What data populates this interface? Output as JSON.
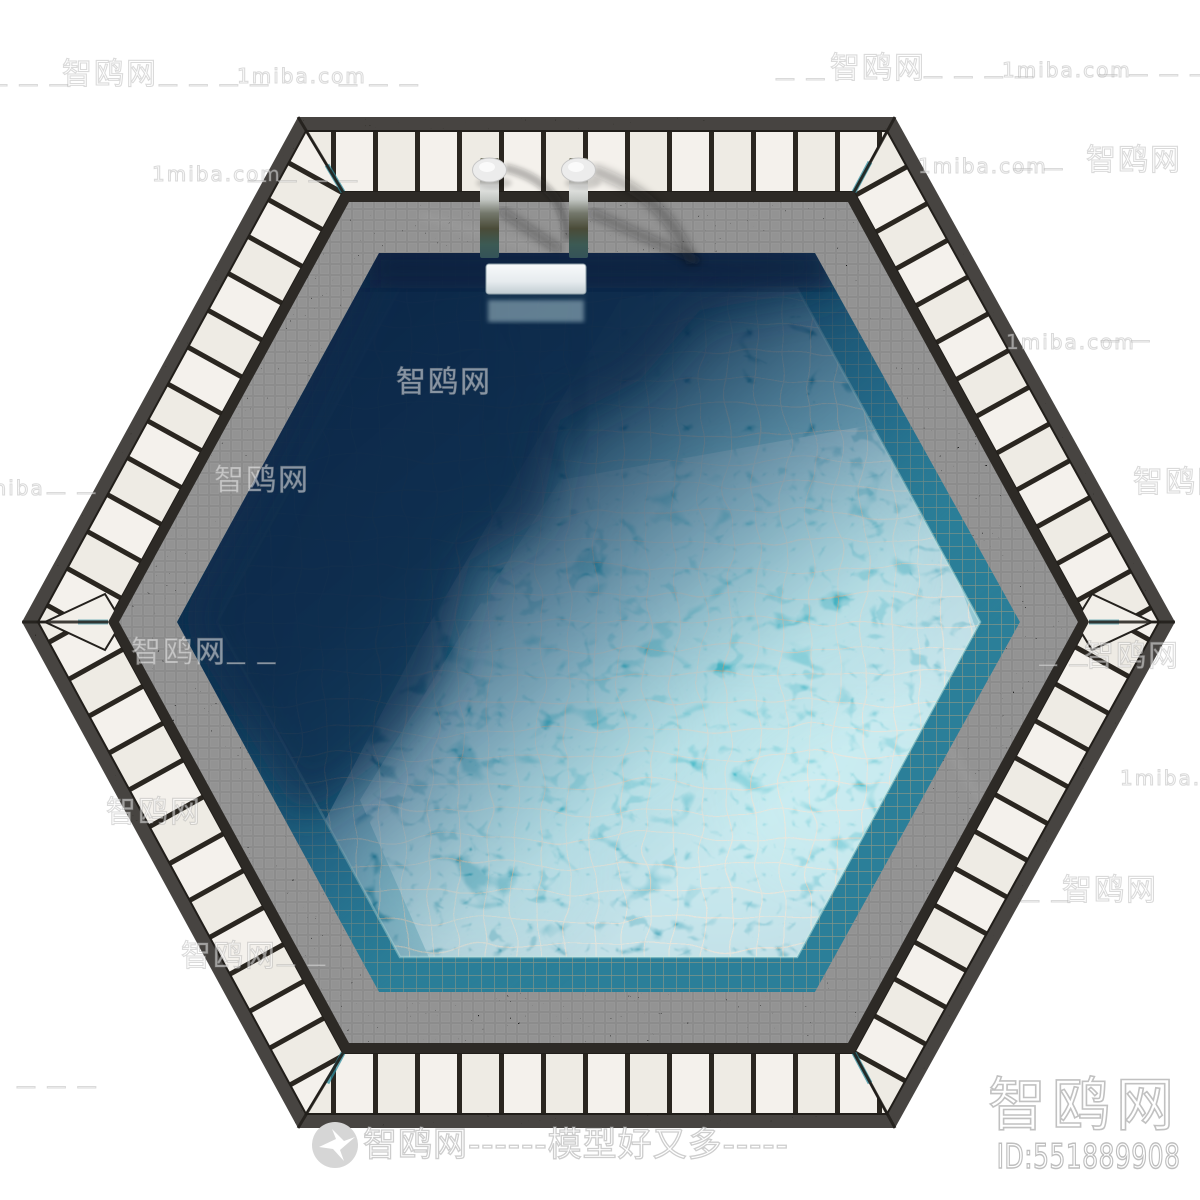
{
  "canvas": {
    "width": 1200,
    "height": 1200,
    "background": "#ffffff"
  },
  "scene": {
    "name": "hexagonal-swimming-pool-top-view-render",
    "colors": {
      "deck_plank": "#f4f1ec",
      "deck_gap": "#2a2620",
      "frame": "#2d2a26",
      "mosaic_tile": "#121212",
      "pool_wall": "#2b7f99",
      "water_bright": "#4ec6d2",
      "water_mid": "#3aa8bd",
      "water_deep": "#1a4a68",
      "water_shadow": "#0c2140",
      "grout": "#cda87e",
      "ladder_metal": "#c2c6c2",
      "ladder_step": "#f8fafb"
    }
  },
  "watermarks": {
    "tiled": [
      {
        "text": "— — —",
        "x": -12,
        "y": 74,
        "size": 20
      },
      {
        "text": "智鸥网",
        "x": 62,
        "y": 60,
        "size": 30
      },
      {
        "text": "— — — —",
        "x": 158,
        "y": 74,
        "size": 20
      },
      {
        "text": "1miba.com",
        "x": 237,
        "y": 66,
        "size": 20
      },
      {
        "text": "— — —",
        "x": 338,
        "y": 74,
        "size": 20
      },
      {
        "text": "— —",
        "x": 775,
        "y": 68,
        "size": 20
      },
      {
        "text": "智鸥网",
        "x": 830,
        "y": 54,
        "size": 30
      },
      {
        "text": "— — — —",
        "x": 923,
        "y": 66,
        "size": 20
      },
      {
        "text": "1miba.com",
        "x": 1002,
        "y": 60,
        "size": 20
      },
      {
        "text": "— — — —",
        "x": 1098,
        "y": 64,
        "size": 20
      },
      {
        "text": "1miba.com",
        "x": 152,
        "y": 164,
        "size": 20
      },
      {
        "text": "— — — —",
        "x": 247,
        "y": 170,
        "size": 20
      },
      {
        "text": "1miba.com",
        "x": 918,
        "y": 156,
        "size": 20
      },
      {
        "text": "— —",
        "x": 1013,
        "y": 158,
        "size": 20
      },
      {
        "text": "智鸥网",
        "x": 1086,
        "y": 146,
        "size": 30
      },
      {
        "text": "智鸥网",
        "x": 396,
        "y": 368,
        "size": 30
      },
      {
        "text": "1miba.com",
        "x": 1006,
        "y": 332,
        "size": 20
      },
      {
        "text": "— —",
        "x": 1100,
        "y": 330,
        "size": 20
      },
      {
        "text": "1miba",
        "x": -28,
        "y": 478,
        "size": 20
      },
      {
        "text": "— —",
        "x": 46,
        "y": 482,
        "size": 20
      },
      {
        "text": "智鸥网",
        "x": 214,
        "y": 466,
        "size": 30
      },
      {
        "text": "智鸥网",
        "x": 1133,
        "y": 468,
        "size": 30
      },
      {
        "text": "智鸥网",
        "x": 131,
        "y": 638,
        "size": 30
      },
      {
        "text": "— —",
        "x": 226,
        "y": 652,
        "size": 20
      },
      {
        "text": "— —",
        "x": 1038,
        "y": 654,
        "size": 20
      },
      {
        "text": "智鸥网",
        "x": 1084,
        "y": 642,
        "size": 30
      },
      {
        "text": "1miba.com",
        "x": 1120,
        "y": 768,
        "size": 20
      },
      {
        "text": "智鸥网",
        "x": 106,
        "y": 798,
        "size": 30
      },
      {
        "text": "— —",
        "x": 1020,
        "y": 890,
        "size": 20
      },
      {
        "text": "智鸥网",
        "x": 1062,
        "y": 876,
        "size": 30
      },
      {
        "text": "智鸥网",
        "x": 181,
        "y": 942,
        "size": 30
      },
      {
        "text": "— —",
        "x": 276,
        "y": 954,
        "size": 20
      },
      {
        "text": "— — —",
        "x": 16,
        "y": 1076,
        "size": 20
      }
    ],
    "banner": {
      "logo_icon": "bird-logo",
      "text": "智鸥网------模型好又多-----"
    },
    "corner": {
      "site_name": "智鸥网",
      "model_id": "ID:551889908"
    }
  }
}
